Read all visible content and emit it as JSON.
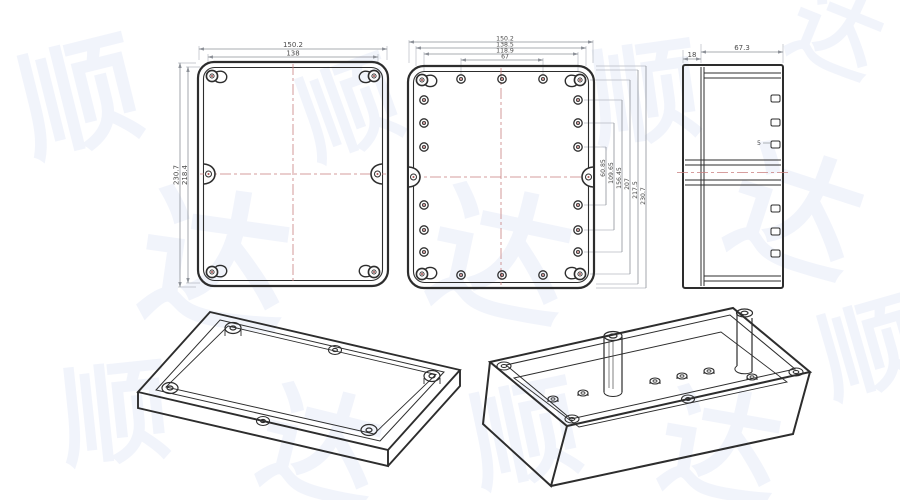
{
  "page": {
    "background": "#ffffff",
    "description": "Technical drawing of plastic waterproof enclosure: lid top view, base top view, side view, two isometric views"
  },
  "colors": {
    "part_line": "#2d2d2d",
    "dim_line": "#a7abb2",
    "dim_text": "#4a4a4a",
    "centerline_red": "#c97f7f",
    "hole_red": "#a84f4f",
    "watermark": "#e9edf9"
  },
  "watermark": {
    "chars": [
      "顺",
      "达",
      "顺",
      "达",
      "顺",
      "达",
      "顺",
      "达",
      "顺",
      "达",
      "顺",
      "达"
    ]
  },
  "views": {
    "lid_top": {
      "label": "lid-top-view",
      "dim_width_outer": "150.2",
      "dim_width_inner": "138",
      "dim_height_outer": "230.7",
      "dim_height_inner": "218.4"
    },
    "base_top": {
      "label": "base-top-view",
      "dims_top": [
        "150.2",
        "138.5",
        "118.9",
        "67"
      ],
      "dims_right": [
        "60.85",
        "109.65",
        "156.45",
        "207",
        "217.5",
        "230.7"
      ]
    },
    "side": {
      "label": "side-view",
      "dim_lid_depth": "18",
      "dim_base_depth": "67.3",
      "dim_tab": "5"
    },
    "lid_iso": {
      "label": "lid-isometric-view"
    },
    "base_iso": {
      "label": "base-isometric-view"
    }
  }
}
